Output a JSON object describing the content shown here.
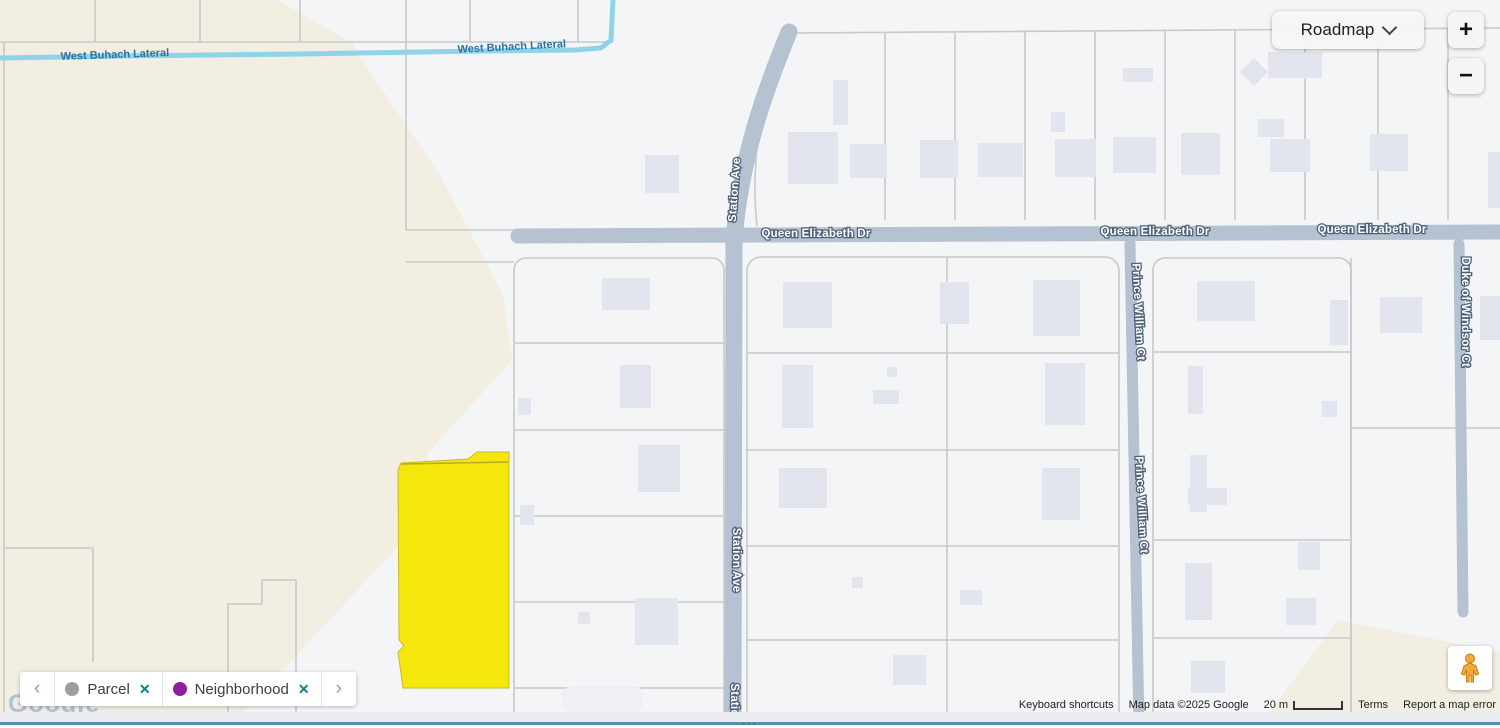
{
  "controls": {
    "map_type": "Roadmap",
    "zoom_in": "+",
    "zoom_out": "−"
  },
  "labels": {
    "water": "West Buhach Lateral",
    "queen_elizabeth": "Queen Elizabeth Dr",
    "station": "Station Ave",
    "station_partial": "Statio",
    "prince_william": "Prince William Ct",
    "duke_of_windsor": "Duke of Windsor Ct"
  },
  "chip_bar": {
    "chips": [
      {
        "label": "Parcel",
        "dot_color": "#9e9e9e",
        "close": "✕"
      },
      {
        "label": "Neighborhood",
        "dot_color": "#8e1f9e",
        "close": "✕"
      }
    ]
  },
  "watermark": "Google",
  "attribution": {
    "keyboard_shortcuts": "Keyboard shortcuts",
    "map_data": "Map data ©2025 Google",
    "scale": "20 m",
    "terms": "Terms",
    "report": "Report a map error"
  },
  "footer": {
    "dots": "..."
  },
  "colors": {
    "road": "#b5c2d2",
    "water": "#8fd3e8",
    "beige": "#f2eee1",
    "building": "#e3e5ee",
    "parcel_highlight": "#f5e60c",
    "parcel_highlight_edge": "#c9bd2e",
    "accent_teal": "#10818f",
    "chip_dot_gray": "#9e9e9e",
    "chip_dot_purple": "#8e1f9e"
  }
}
